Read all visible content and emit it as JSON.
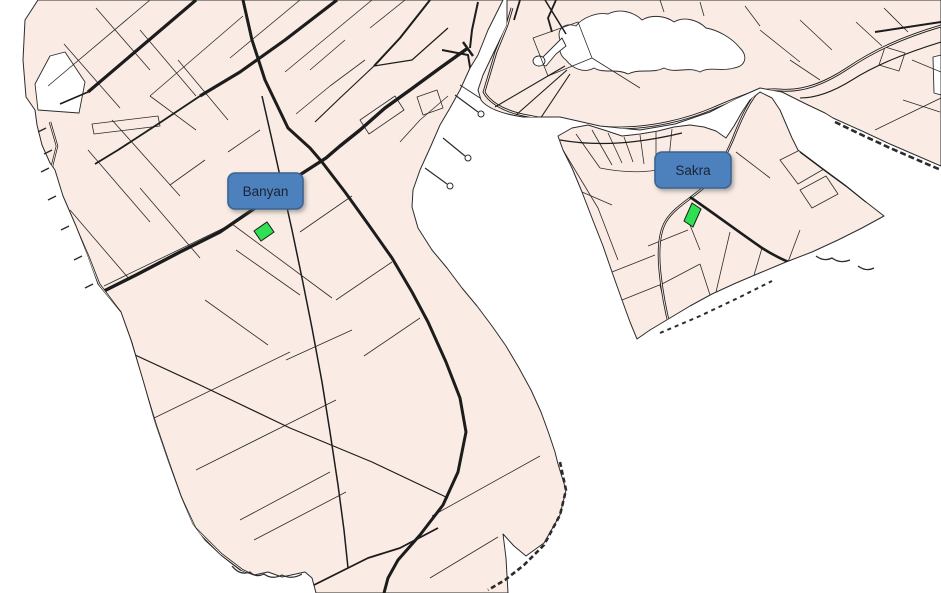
{
  "map": {
    "kind": "parcel-map",
    "labels": {
      "banyan": {
        "text": "Banyan"
      },
      "sakra": {
        "text": "Sakra"
      }
    },
    "highlights": {
      "banyan_parcel": {
        "near_label": "Banyan",
        "color": "#2fe152"
      },
      "sakra_parcel": {
        "near_label": "Sakra",
        "color": "#2fe152"
      }
    },
    "colors": {
      "water": "#ffffff",
      "land": "#faece5",
      "outline": "#2b2b2b",
      "road": "#1c1c1c",
      "label-fill": "#4e81bd",
      "label-border": "#3a648f",
      "label-text": "#1a2433",
      "highlight-green": "#2fe152"
    }
  }
}
